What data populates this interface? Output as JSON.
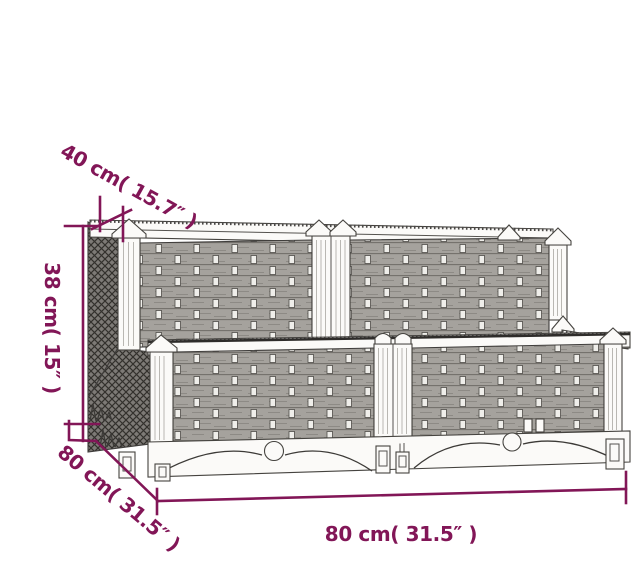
{
  "colors": {
    "accent": "#821657",
    "ink": "#44423e"
  },
  "diagram": {
    "kind": "product-dimension-line-drawing",
    "dimensions": {
      "top_depth_label": "40 cm( 15.7″ )",
      "height_label": "38 cm( 15″ )",
      "base_depth_label": "80 cm( 31.5″ )",
      "width_label": "80 cm( 31.5″ )"
    }
  }
}
